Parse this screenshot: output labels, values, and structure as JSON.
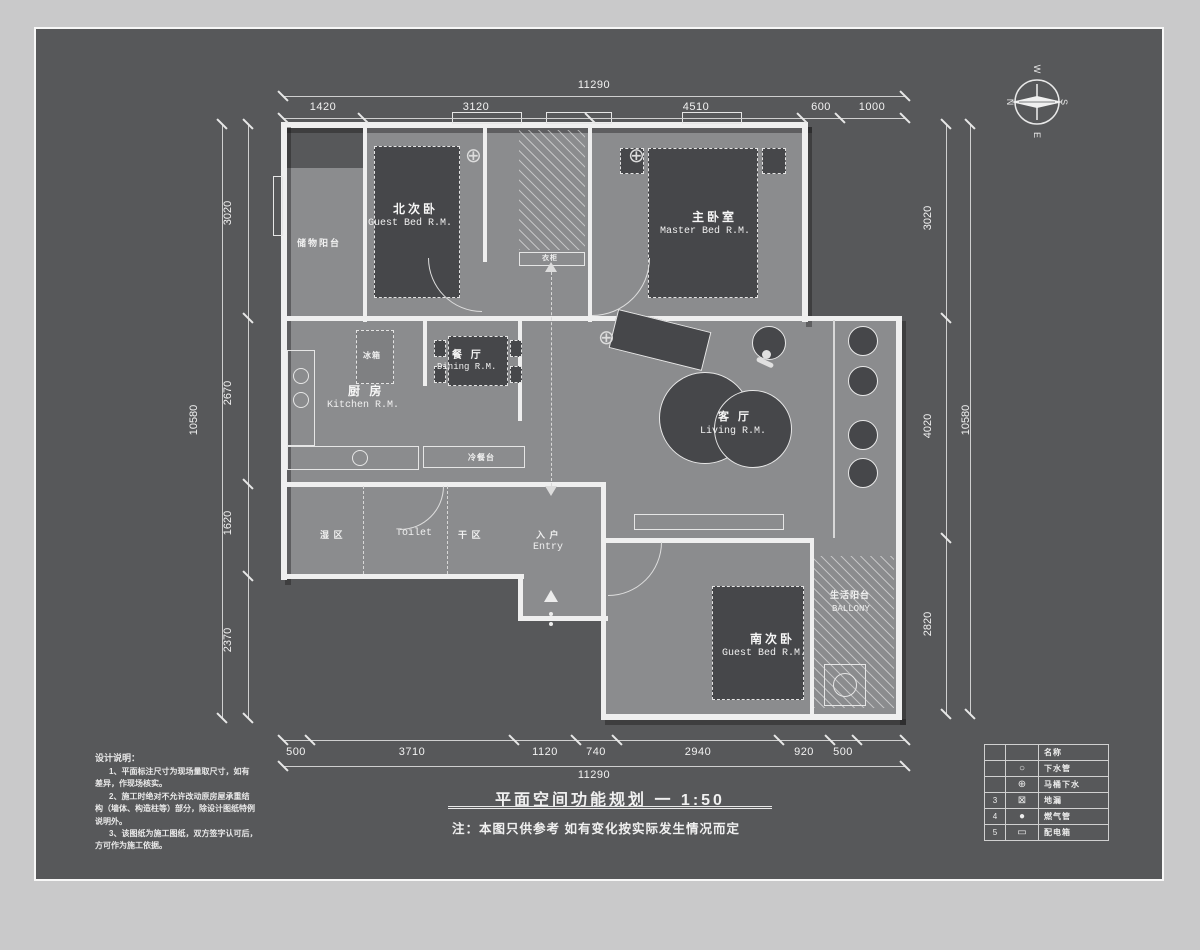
{
  "title_block": {
    "drawing_title": "平面空间功能规划 一  1:50",
    "note": "注：本图只供参考 如有变化按实际发生情况而定"
  },
  "design_notes": {
    "title": "设计说明：",
    "lines": [
      "1、平面标注尺寸为现场量取尺寸，如有",
      "差异，作现场核实。",
      "2、施工时绝对不允许改动原房屋承重结",
      "构（墙体、构造柱等）部分，除设计图纸特例",
      "说明外。",
      "3、该图纸为施工图纸，双方签字认可后，",
      "方可作为施工依据。"
    ]
  },
  "compass": {
    "north": "N",
    "south": "S",
    "east": "E",
    "west": "W"
  },
  "icons": {
    "light": "⊕"
  },
  "dimensions": {
    "top": {
      "overall": "11290",
      "segments": [
        "1420",
        "3120",
        "4510",
        "600",
        "1000"
      ]
    },
    "bottom": {
      "overall": "11290",
      "segments": [
        "500",
        "3710",
        "1120",
        "740",
        "2940",
        "920",
        "500"
      ]
    },
    "left": {
      "overall": "10580",
      "segments": [
        "3020",
        "2670",
        "1620",
        "2370"
      ]
    },
    "right": {
      "overall": "10580",
      "segments": [
        "3020",
        "4020",
        "2820"
      ]
    }
  },
  "rooms": {
    "storage_balcony": {
      "cn": "储物阳台"
    },
    "north_bedroom": {
      "cn": "北次卧",
      "en": "Guest Bed R.M."
    },
    "master_bedroom": {
      "cn": "主卧室",
      "en": "Master Bed R.M."
    },
    "kitchen": {
      "cn": "厨 房",
      "en": "Kitchen R.M."
    },
    "dining": {
      "cn": "餐 厅",
      "en": "Dining R.M."
    },
    "living": {
      "cn": "客 厅",
      "en": "Living R.M."
    },
    "south_bedroom": {
      "cn": "南次卧",
      "en": "Guest Bed R.M."
    },
    "toilet": {
      "en": "Toilet"
    },
    "wet_zone": {
      "cn": "湿 区"
    },
    "dry_zone": {
      "cn": "干 区"
    },
    "entry": {
      "cn": "入 户",
      "en": "Entry"
    },
    "life_balcony": {
      "cn": "生活阳台",
      "en": "BALLONY"
    },
    "fridge": {
      "cn": "冰箱"
    },
    "cold_counter": {
      "cn": "冷餐台"
    },
    "wardrobe": {
      "cn": "衣柜"
    }
  },
  "legend": {
    "header_name": "名称",
    "rows": [
      {
        "no": "",
        "symbol": "○",
        "name": "下水管"
      },
      {
        "no": "",
        "symbol": "⊕",
        "name": "马桶下水"
      },
      {
        "no": "3",
        "symbol": "⊠",
        "name": "地漏"
      },
      {
        "no": "4",
        "symbol": "●",
        "name": "燃气管"
      },
      {
        "no": "5",
        "symbol": "▭",
        "name": "配电箱"
      }
    ]
  }
}
